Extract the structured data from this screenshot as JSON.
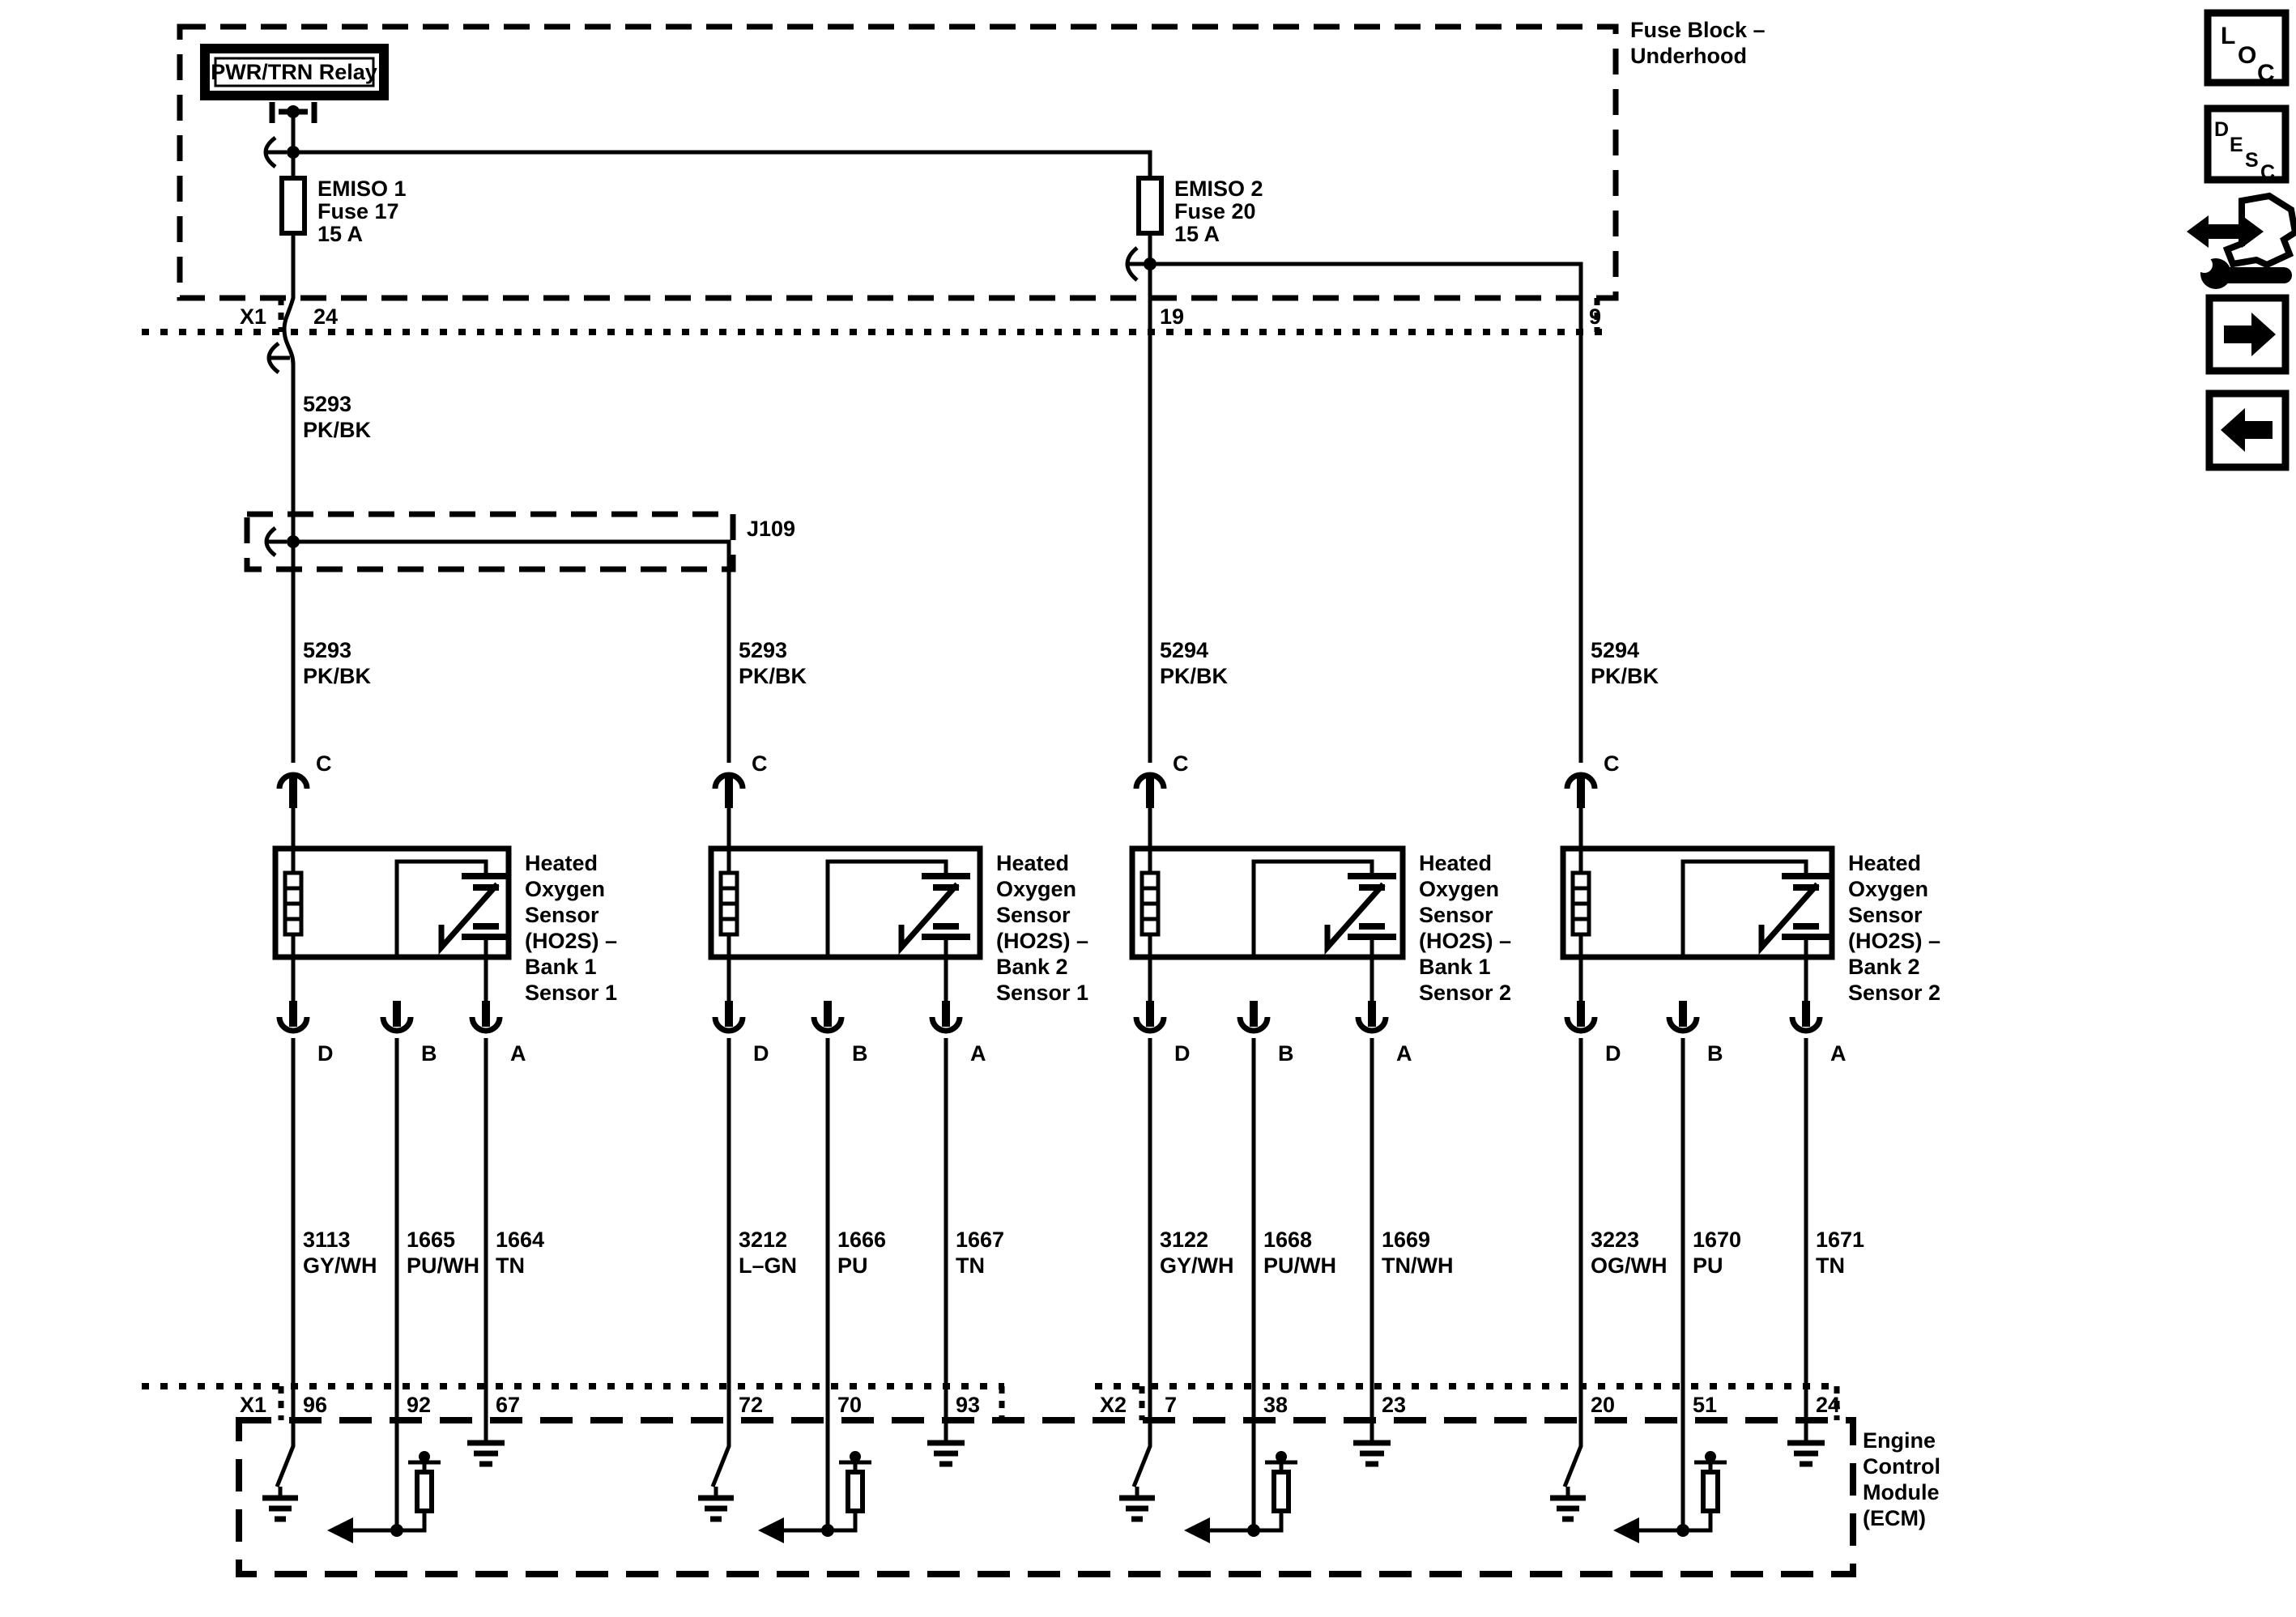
{
  "relay": {
    "label": "PWR/TRN Relay"
  },
  "fuse_block": {
    "line1": "Fuse Block –",
    "line2": "Underhood"
  },
  "fuses": [
    {
      "name": "EMISO 1",
      "id": "Fuse 17",
      "rating": "15 A"
    },
    {
      "name": "EMISO 2",
      "id": "Fuse 20",
      "rating": "15 A"
    }
  ],
  "splice": {
    "label": "J109"
  },
  "top_connector": {
    "label": "X1",
    "pin_fuse1": "24",
    "pin_fuse2": "19",
    "pin_branch": "9"
  },
  "groups": [
    {
      "feed_upper": {
        "circuit": "5293",
        "color": "PK/BK"
      },
      "feed": {
        "circuit": "5293",
        "color": "PK/BK"
      },
      "top_pin": "C",
      "name": [
        "Heated",
        "Oxygen",
        "Sensor",
        "(HO2S) –",
        "Bank 1",
        "Sensor 1"
      ],
      "pins": [
        "D",
        "B",
        "A"
      ],
      "wires": [
        {
          "circuit": "3113",
          "color": "GY/WH",
          "ecm_pin": "96"
        },
        {
          "circuit": "1665",
          "color": "PU/WH",
          "ecm_pin": "92"
        },
        {
          "circuit": "1664",
          "color": "TN",
          "ecm_pin": "67"
        }
      ]
    },
    {
      "feed": {
        "circuit": "5293",
        "color": "PK/BK"
      },
      "top_pin": "C",
      "name": [
        "Heated",
        "Oxygen",
        "Sensor",
        "(HO2S) –",
        "Bank 2",
        "Sensor 1"
      ],
      "pins": [
        "D",
        "B",
        "A"
      ],
      "wires": [
        {
          "circuit": "3212",
          "color": "L–GN",
          "ecm_pin": "72"
        },
        {
          "circuit": "1666",
          "color": "PU",
          "ecm_pin": "70"
        },
        {
          "circuit": "1667",
          "color": "TN",
          "ecm_pin": "93"
        }
      ]
    },
    {
      "feed": {
        "circuit": "5294",
        "color": "PK/BK"
      },
      "top_pin": "C",
      "name": [
        "Heated",
        "Oxygen",
        "Sensor",
        "(HO2S) –",
        "Bank 1",
        "Sensor 2"
      ],
      "pins": [
        "D",
        "B",
        "A"
      ],
      "wires": [
        {
          "circuit": "3122",
          "color": "GY/WH",
          "ecm_pin": "7"
        },
        {
          "circuit": "1668",
          "color": "PU/WH",
          "ecm_pin": "38"
        },
        {
          "circuit": "1669",
          "color": "TN/WH",
          "ecm_pin": "23"
        }
      ]
    },
    {
      "feed": {
        "circuit": "5294",
        "color": "PK/BK"
      },
      "top_pin": "C",
      "name": [
        "Heated",
        "Oxygen",
        "Sensor",
        "(HO2S) –",
        "Bank 2",
        "Sensor 2"
      ],
      "pins": [
        "D",
        "B",
        "A"
      ],
      "wires": [
        {
          "circuit": "3223",
          "color": "OG/WH",
          "ecm_pin": "20"
        },
        {
          "circuit": "1670",
          "color": "PU",
          "ecm_pin": "51"
        },
        {
          "circuit": "1671",
          "color": "TN",
          "ecm_pin": "24"
        }
      ]
    }
  ],
  "ecm": {
    "x1": "X1",
    "x2": "X2",
    "label": [
      "Engine",
      "Control",
      "Module",
      "(ECM)"
    ]
  },
  "icons": {
    "loc": [
      "L",
      "O",
      "C"
    ],
    "desc": [
      "D",
      "E",
      "S",
      "C"
    ]
  }
}
